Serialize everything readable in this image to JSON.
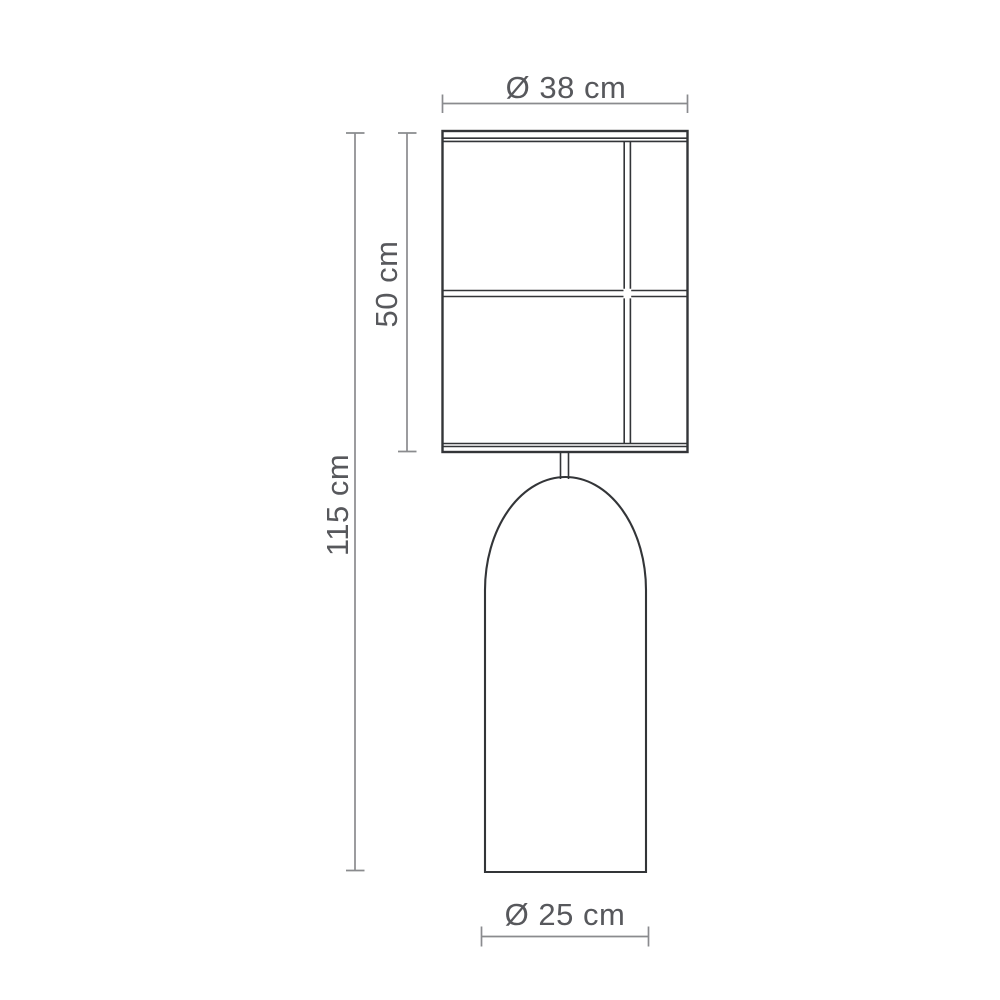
{
  "diagram": {
    "type": "technical-dimension-drawing",
    "subject": "floor lamp with rectangular panel shade and bullet-shaped base",
    "dimensions": {
      "shade_diameter_label": "Ø 38 cm",
      "shade_height_label": "50 cm",
      "total_height_label": "115 cm",
      "base_diameter_label": "Ø 25 cm"
    },
    "colors": {
      "drawing_line": "#333538",
      "dimension_line": "#8a8b8e",
      "dimension_text": "#57585c",
      "background": "#ffffff"
    }
  }
}
